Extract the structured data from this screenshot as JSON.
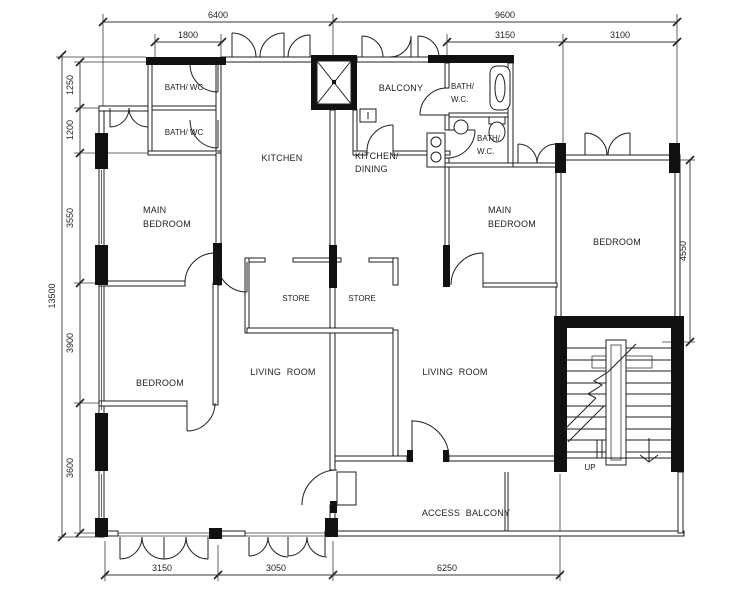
{
  "drawing": {
    "rooms": {
      "bath_wc_left_1": "BATH/ WC",
      "bath_wc_left_2": "BATH/ WC",
      "kitchen": "KITCHEN",
      "kitchen_dining_line1": "KITCHEN/",
      "kitchen_dining_line2": "DINING",
      "balcony": "BALCONY",
      "bath_wc_right_1_line1": "BATH/",
      "bath_wc_right_1_line2": "W.C.",
      "bath_wc_right_2_line1": "BATH/",
      "bath_wc_right_2_line2": "W.C.",
      "main_bedroom_left_line1": "MAIN",
      "main_bedroom_left_line2": "BEDROOM",
      "main_bedroom_right_line1": "MAIN",
      "main_bedroom_right_line2": "BEDROOM",
      "bedroom_right": "BEDROOM",
      "bedroom_left": "BEDROOM",
      "store_left": "STORE",
      "store_right": "STORE",
      "living_room_left": "LIVING ROOM",
      "living_room_right": "LIVING ROOM",
      "access_balcony": "ACCESS BALCONY",
      "stair_direction": "UP"
    },
    "dims": {
      "top_left_width": "6400",
      "top_right_width": "9600",
      "bath_block_width": "1800",
      "upper_right_a": "3150",
      "upper_right_b": "3100",
      "overall_height": "13500",
      "left_1": "1250",
      "left_2": "1200",
      "left_3": "3550",
      "left_4": "3900",
      "left_5": "3600",
      "bedroom_height": "4550",
      "bottom_a": "3150",
      "bottom_b": "3050",
      "bottom_c": "6250"
    },
    "colors": {
      "line": "#1f1f1f",
      "wall_fill": "#111111",
      "dim": "#3a3a3a",
      "paper": "#ffffff"
    }
  }
}
